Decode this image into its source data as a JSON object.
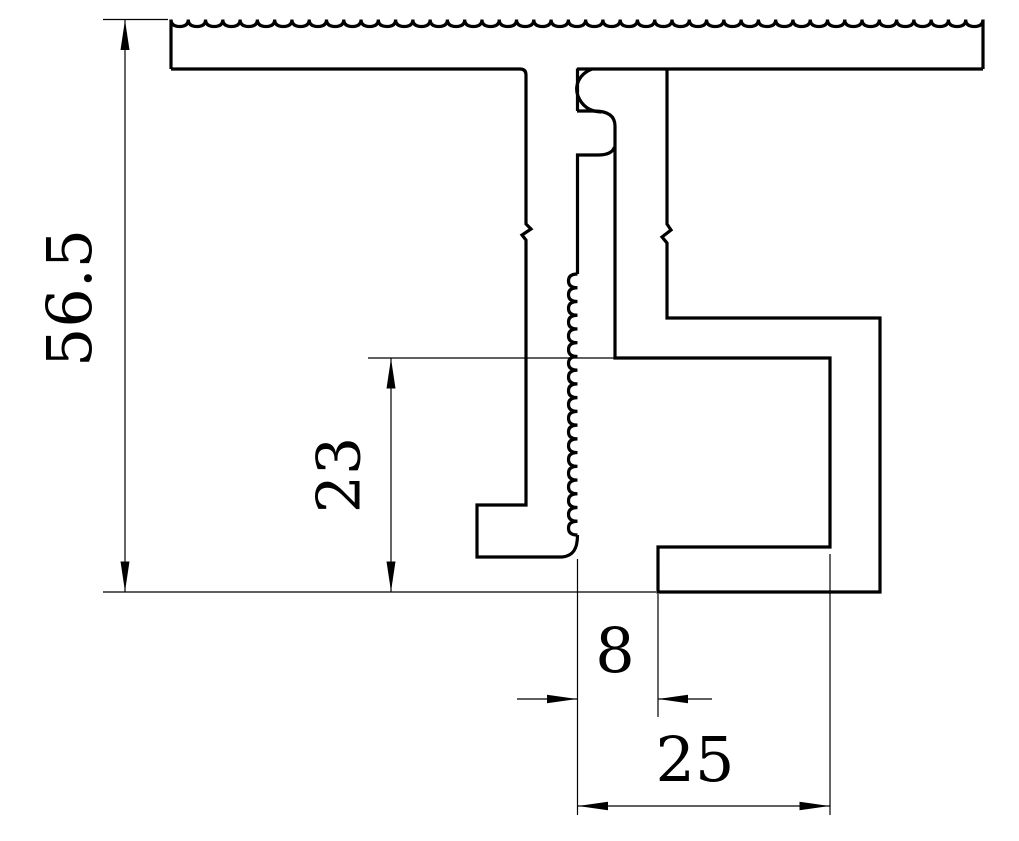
{
  "drawing": {
    "type": "profile-cross-section",
    "colors": {
      "background": "#ffffff",
      "line": "#000000"
    },
    "dimensions": [
      {
        "id": "overall-height",
        "label": "56.5",
        "orientation": "vertical"
      },
      {
        "id": "inner-leg-height",
        "label": "23",
        "orientation": "vertical"
      },
      {
        "id": "slot-width",
        "label": "8",
        "orientation": "horizontal"
      },
      {
        "id": "base-width",
        "label": "25",
        "orientation": "horizontal"
      }
    ]
  }
}
